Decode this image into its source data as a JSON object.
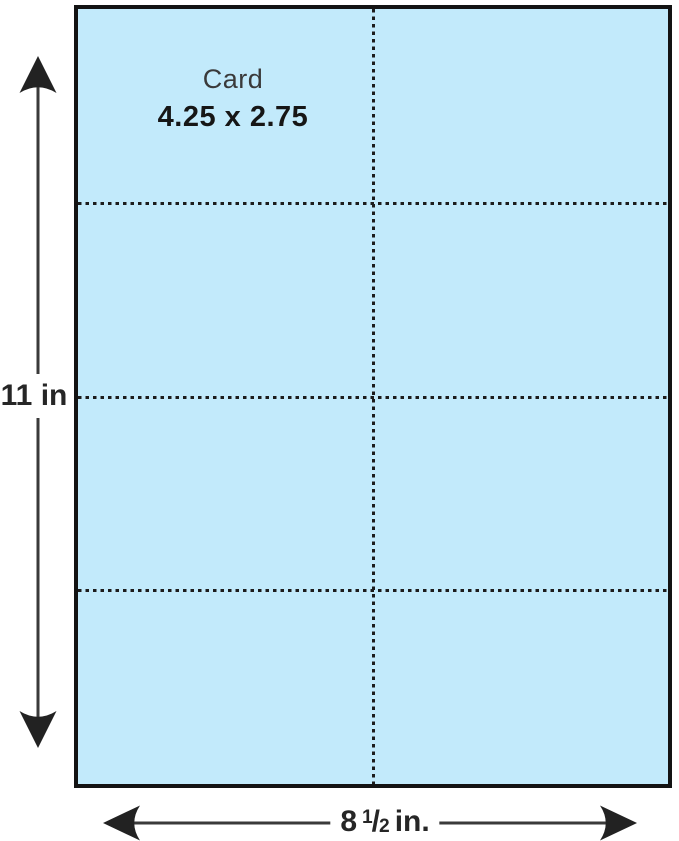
{
  "sheet": {
    "fill_color": "#c2eafb",
    "border_color": "#131313",
    "columns": 2,
    "rows": 4,
    "card_label": {
      "title": "Card",
      "size": "4.25 x 2.75"
    }
  },
  "dimensions": {
    "height": {
      "label": "11 in"
    },
    "width": {
      "whole": "8",
      "numerator": "1",
      "fraction_slash": "/",
      "denominator": "2",
      "unit": "in."
    }
  },
  "colors": {
    "arrow": "#2a2a2a",
    "perforation": "#1c1c1c",
    "background": "#ffffff"
  }
}
